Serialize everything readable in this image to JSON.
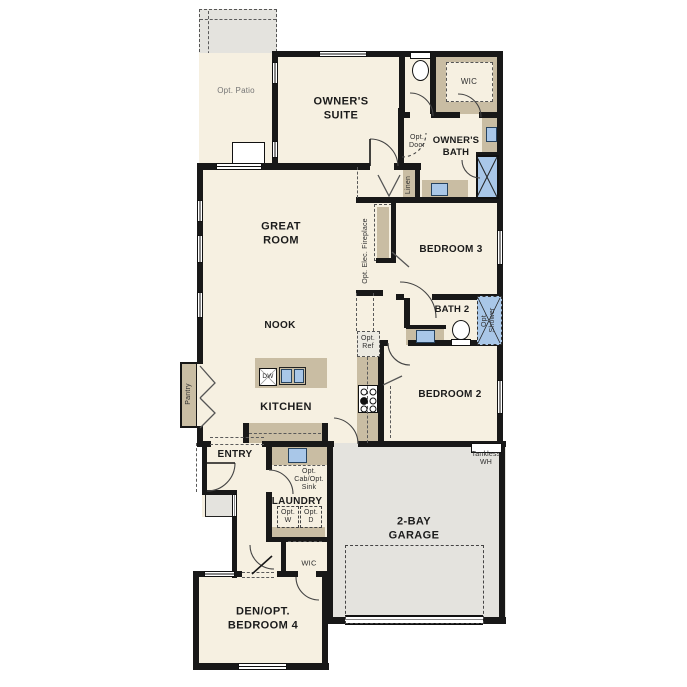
{
  "palette": {
    "floor": "#f6f0e1",
    "outdoor": "#e4e3de",
    "cabinet": "#c9bda3",
    "fixture": "#a9c7e8",
    "wall": "#181818",
    "ink": "#1b1b1b"
  },
  "labels": {
    "opt_patio": "Opt. Patio",
    "owners_suite": "OWNER'S\nSUITE",
    "owners_wic": "WIC",
    "owners_bath": "OWNER'S\nBATH",
    "opt_door": "Opt.\nDoor",
    "linen": "Linen",
    "great_room": "GREAT\nROOM",
    "opt_elec_fireplace": "Opt. Elec. Fireplace",
    "bedroom3": "BEDROOM 3",
    "bath2": "BATH 2",
    "opt_shower": "Opt.\nShower",
    "nook": "NOOK",
    "opt_ref": "Opt.\nRef",
    "kitchen": "KITCHEN",
    "dishwasher": "DW",
    "pantry": "Pantry",
    "entry": "ENTRY",
    "opt_cab_sink": "Opt.\nCab/Opt.\nSink",
    "laundry": "LAUNDRY",
    "opt_washer": "Opt.\nW",
    "opt_dryer": "Opt.\nD",
    "bedroom2": "BEDROOM 2",
    "bedroom4_wic": "WIC",
    "tankless_wh": "Tankless\nWH",
    "garage": "2-BAY\nGARAGE",
    "den": "DEN/OPT.\nBEDROOM 4"
  }
}
